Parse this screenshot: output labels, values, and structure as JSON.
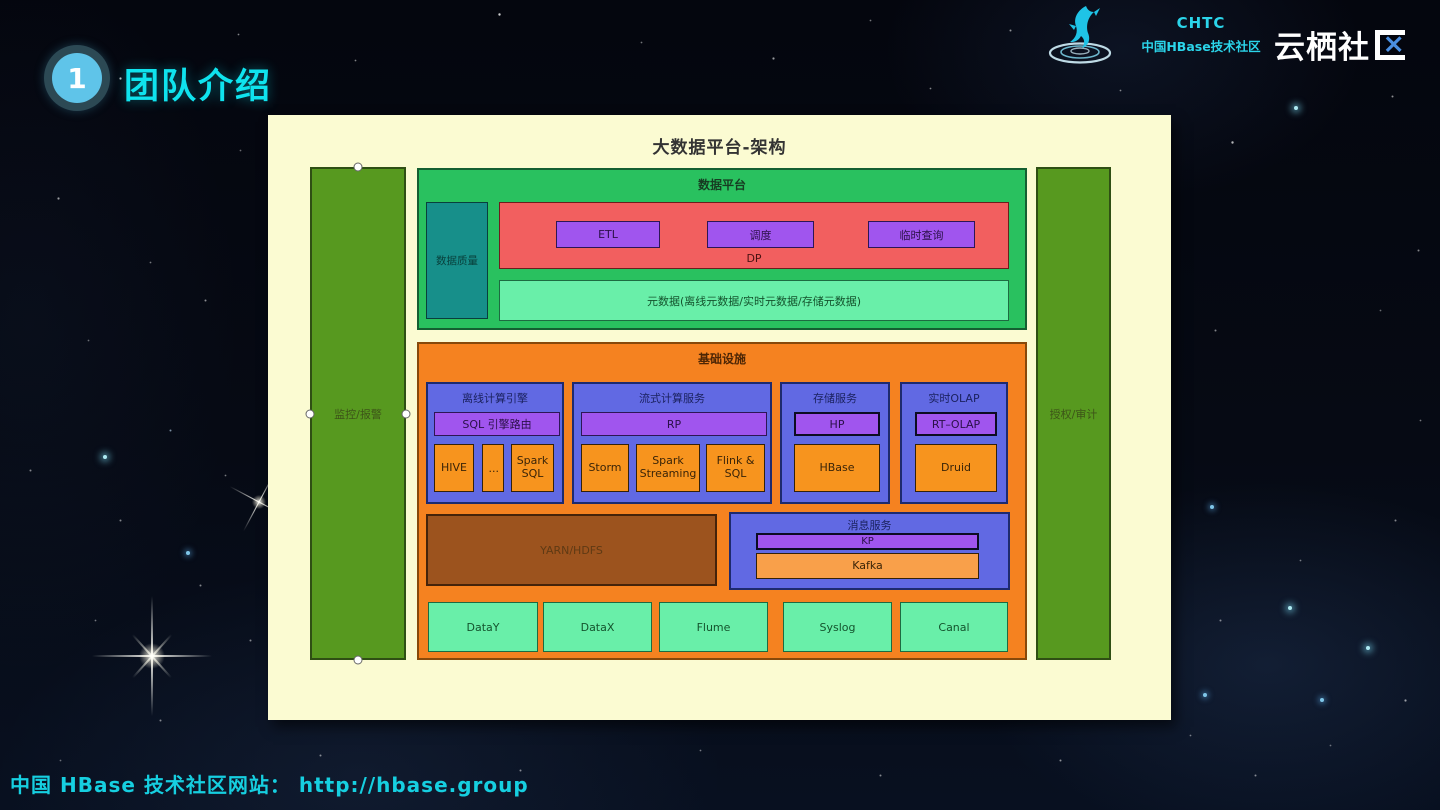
{
  "header": {
    "badge_number": "1",
    "title": "团队介绍"
  },
  "logos": {
    "chtc_acronym": "CHTC",
    "chtc_name": "中国HBase技术社区",
    "yunqi_prefix": "云栖社",
    "yunqi_x": "×"
  },
  "slide": {
    "title": "大数据平台-架构",
    "left_bar": "监控/报警",
    "right_bar": "授权/审计",
    "data_platform": {
      "title": "数据平台",
      "data_quality": "数据质量",
      "dp": {
        "label": "DP",
        "items": [
          "ETL",
          "调度",
          "临时查询"
        ]
      },
      "metadata": "元数据(离线元数据/实时元数据/存储元数据)"
    },
    "infrastructure": {
      "title": "基础设施",
      "groups": [
        {
          "title": "离线计算引擎",
          "bus": "SQL 引擎路由",
          "items": [
            "HIVE",
            "...",
            "Spark SQL"
          ]
        },
        {
          "title": "流式计算服务",
          "bus": "RP",
          "items": [
            "Storm",
            "Spark Streaming",
            "Flink & SQL"
          ]
        },
        {
          "title": "存储服务",
          "bus": "HP",
          "items": [
            "HBase"
          ]
        },
        {
          "title": "实时OLAP",
          "bus": "RT–OLAP",
          "items": [
            "Druid"
          ]
        }
      ],
      "yarn": "YARN/HDFS",
      "message_service": {
        "title": "消息服务",
        "bus": "KP",
        "item": "Kafka"
      },
      "ingest": [
        "DataY",
        "DataX",
        "Flume",
        "Syslog",
        "Canal"
      ]
    }
  },
  "footer": {
    "text": "中国 HBase 技术社区网站： http://hbase.group"
  },
  "colors": {
    "accent_cyan": "#0fe3ee",
    "slide_bg": "#fbfbd2",
    "platform_green": "#29c15f",
    "infra_orange": "#f58220",
    "card_blue": "#6169e3",
    "bus_purple": "#a055ee",
    "dp_red": "#f25f5f",
    "mint_green": "#69efa9",
    "quality_teal": "#178f8a",
    "yarn_brown": "#9c531e",
    "sidebar_olive": "#57991f",
    "yunqi_blue": "#4a8fe2"
  }
}
